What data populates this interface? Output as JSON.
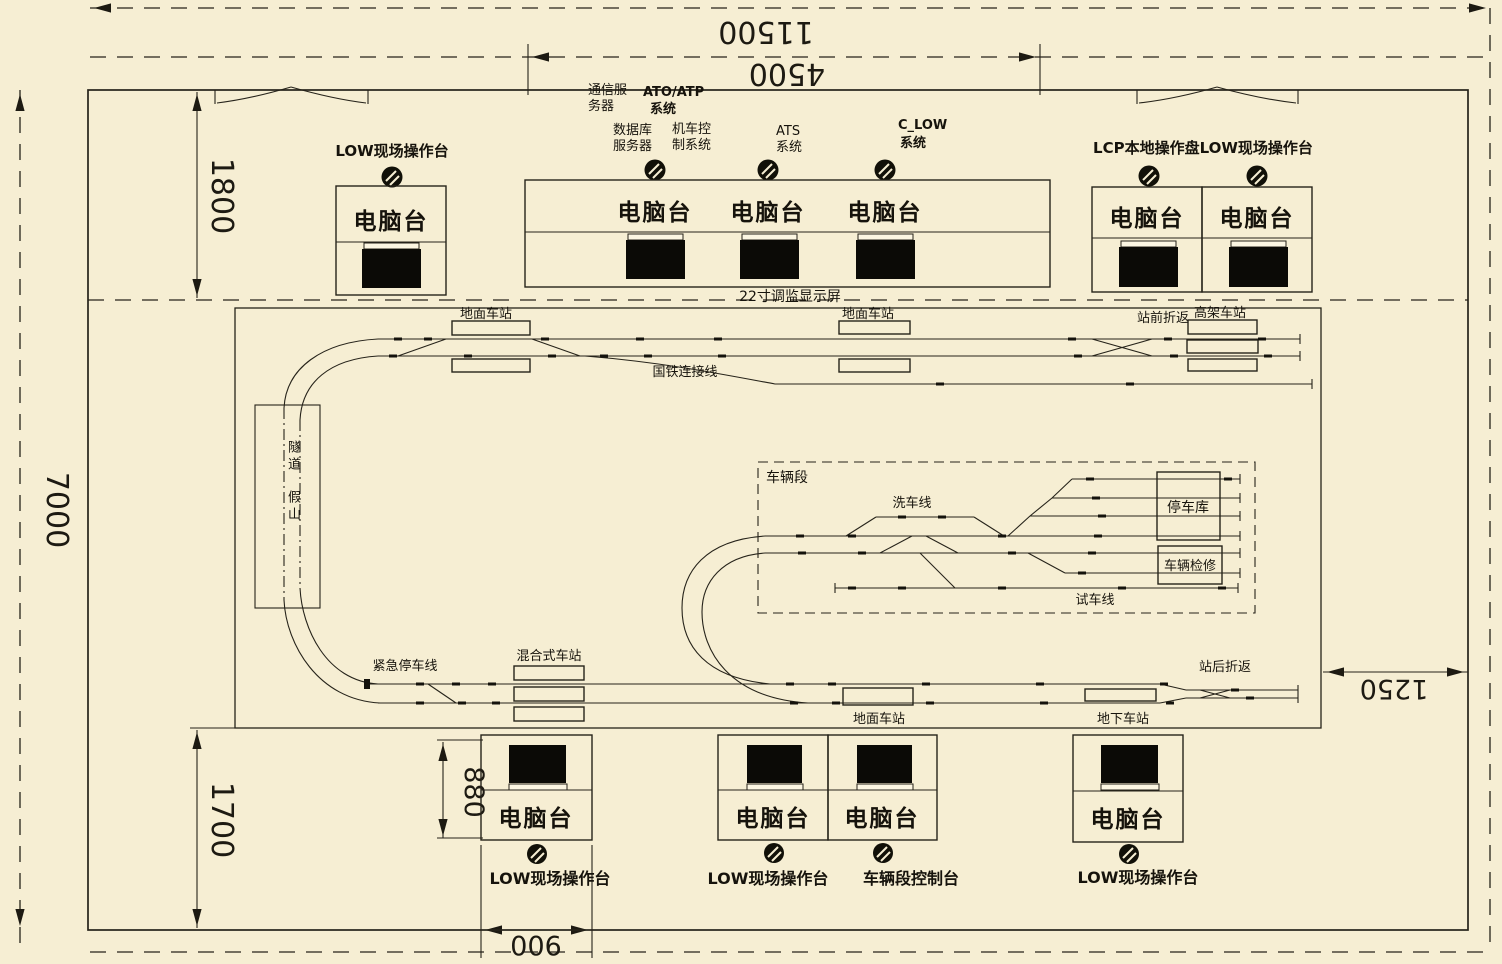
{
  "colors": {
    "bg": "#f6eed3",
    "ink": "#26231a"
  },
  "dimensions": {
    "total_width": "11500",
    "console_row_width": "4500",
    "top_zone_depth": "1800",
    "room_depth": "7000",
    "bottom_zone_depth": "1700",
    "right_clearance": "1250",
    "desk_depth": "880",
    "desk_width": "900"
  },
  "consoles": {
    "desk_label": "电脑台",
    "top_left_caption": "LOW现场操作台",
    "top_right_caption": "LCP本地操作盘LOW现场操作台",
    "monitor_row_caption": "22寸调监显示屏",
    "bottom_captions": [
      "LOW现场操作台",
      "LOW现场操作台",
      "车辆段控制台",
      "LOW现场操作台"
    ]
  },
  "system_labels": [
    {
      "line1": "通信服",
      "line2": "务器"
    },
    {
      "line1": "ATO/ATP",
      "line2": "系统"
    },
    {
      "line1": "数据库",
      "line2": "服务器"
    },
    {
      "line1": "机车控",
      "line2": "制系统"
    },
    {
      "line1": "ATS",
      "line2": "系统"
    },
    {
      "line1": "C_LOW",
      "line2": "系统"
    }
  ],
  "track": {
    "ground_station_top_left": "地面车站",
    "national_rail_link": "国铁连接线",
    "ground_station_top_mid": "地面车站",
    "front_turnback": "站前折返",
    "elevated_station": "高架车站",
    "tunnel": "隧道",
    "rockery": "假山",
    "depot": "车辆段",
    "wash_line": "洗车线",
    "parking_garage": "停车库",
    "vehicle_maintenance": "车辆检修",
    "test_line": "试车线",
    "emergency_stop_line": "紧急停车线",
    "mixed_station": "混合式车站",
    "ground_station_bottom": "地面车站",
    "underground_station": "地下车站",
    "rear_turnback": "站后折返"
  }
}
